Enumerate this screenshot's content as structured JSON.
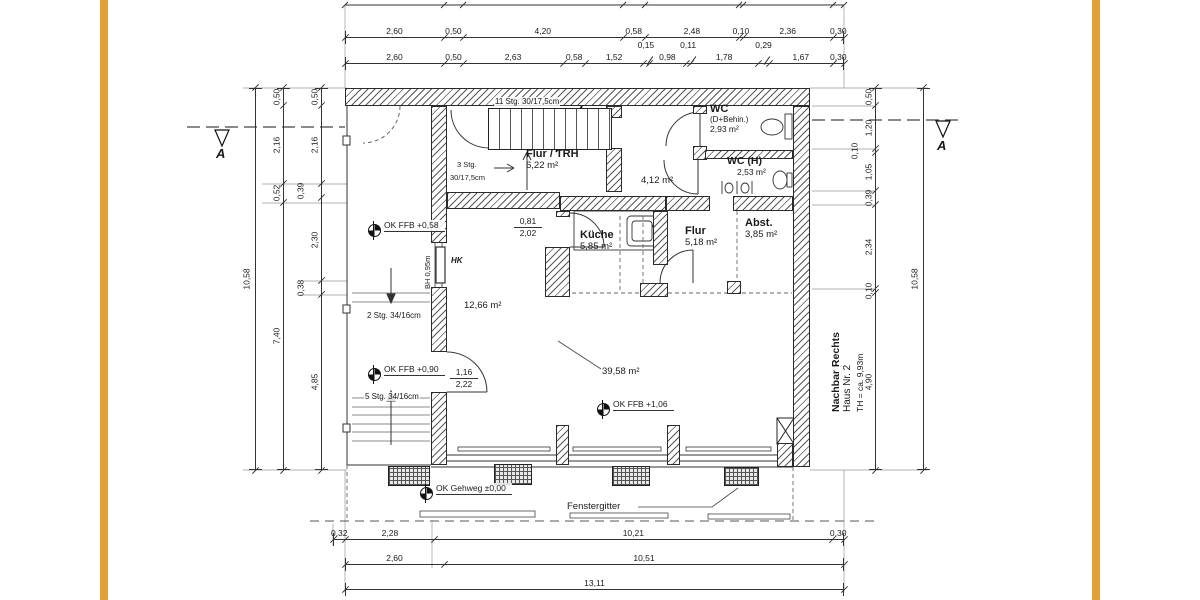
{
  "frame": {
    "accent_color": "#E2A139"
  },
  "rooms": {
    "flur_trh": {
      "name": "Flur / TRH",
      "area": "6,22 m²"
    },
    "wc_d": {
      "name": "WC",
      "sub": "(D+Behin.)",
      "area": "2,93 m²"
    },
    "wc_h": {
      "name": "WC (H)",
      "area": "2,53 m²"
    },
    "hall": {
      "area": "4,12 m²"
    },
    "kueche": {
      "name": "Küche",
      "area": "5,85 m²"
    },
    "flur": {
      "name": "Flur",
      "area": "5,18 m²"
    },
    "abst": {
      "name": "Abst.",
      "area": "3,85 m²"
    },
    "room_left": {
      "area": "12,66 m²"
    },
    "room_main": {
      "area": "39,58 m²"
    }
  },
  "levels": {
    "ffb_058": "OK FFB  +0,58",
    "ffb_090": "OK FFB  +0,90",
    "ffb_106": "OK FFB  +1,06",
    "gehweg": "OK Gehweg  ±0,00"
  },
  "stairs": {
    "main": "11 Stg. 30/17,5cm",
    "three_line1": "3 Stg.",
    "three_line2": "30/17,5cm",
    "two": "2 Stg. 34/16cm",
    "five": "5 Stg. 34/16cm"
  },
  "door_dims": {
    "kitchen_w": "0,81",
    "kitchen_h": "2,02",
    "entry_w": "1,16",
    "entry_h": "2,22"
  },
  "annotations": {
    "bh": "BH 0,95m",
    "hk": "HK",
    "fenstergitter": "Fenstergitter",
    "section_label": "A",
    "neighbor_line1": "Nachbar Rechts",
    "neighbor_line2": "Haus Nr. 2",
    "neighbor_line3": "TH = ca. 9,93m"
  },
  "dimensions": {
    "chains": [
      {
        "id": "top1",
        "orient": "h",
        "values": [
          "2,60",
          "0,50",
          "4,20",
          "0,58",
          "2,48",
          "0,10",
          "2,36",
          "0,30"
        ],
        "offset_indexes": []
      },
      {
        "id": "top2",
        "orient": "h",
        "values": [
          "2,60",
          "0,50",
          "2,63",
          "0,58",
          "1,52",
          "0,15",
          "0,98",
          "0,11",
          "1,78",
          "0,29",
          "1,67",
          "0,30"
        ],
        "offset_indexes": [
          5,
          7,
          9
        ]
      },
      {
        "id": "bottom1",
        "orient": "h",
        "values": [
          "0,32",
          "2,28",
          "10,21",
          "0,30"
        ],
        "offset_indexes": []
      },
      {
        "id": "bottom2",
        "orient": "h",
        "values": [
          "2,60",
          "10,51"
        ],
        "offset_indexes": []
      },
      {
        "id": "bottom3",
        "orient": "h",
        "values": [
          "13,11"
        ],
        "offset_indexes": []
      },
      {
        "id": "left_outer",
        "orient": "v",
        "values": [
          "10,58"
        ],
        "offset_indexes": []
      },
      {
        "id": "left_mid",
        "orient": "v",
        "values": [
          "0,50",
          "2,16",
          "0,52",
          "7,40"
        ],
        "offset_indexes": []
      },
      {
        "id": "left_inner",
        "orient": "v",
        "values": [
          "0,50",
          "2,16",
          "0,39",
          "2,30",
          "0,38",
          "4,85"
        ],
        "offset_indexes": [
          2,
          4
        ]
      },
      {
        "id": "right_inner",
        "orient": "v",
        "values": [
          "0,50",
          "1,20",
          "0,10",
          "1,05",
          "0,39",
          "2,34",
          "0,10",
          "4,90"
        ],
        "offset_indexes": [
          2
        ]
      },
      {
        "id": "right_outer",
        "orient": "v",
        "values": [
          "10,58"
        ],
        "offset_indexes": []
      }
    ]
  }
}
